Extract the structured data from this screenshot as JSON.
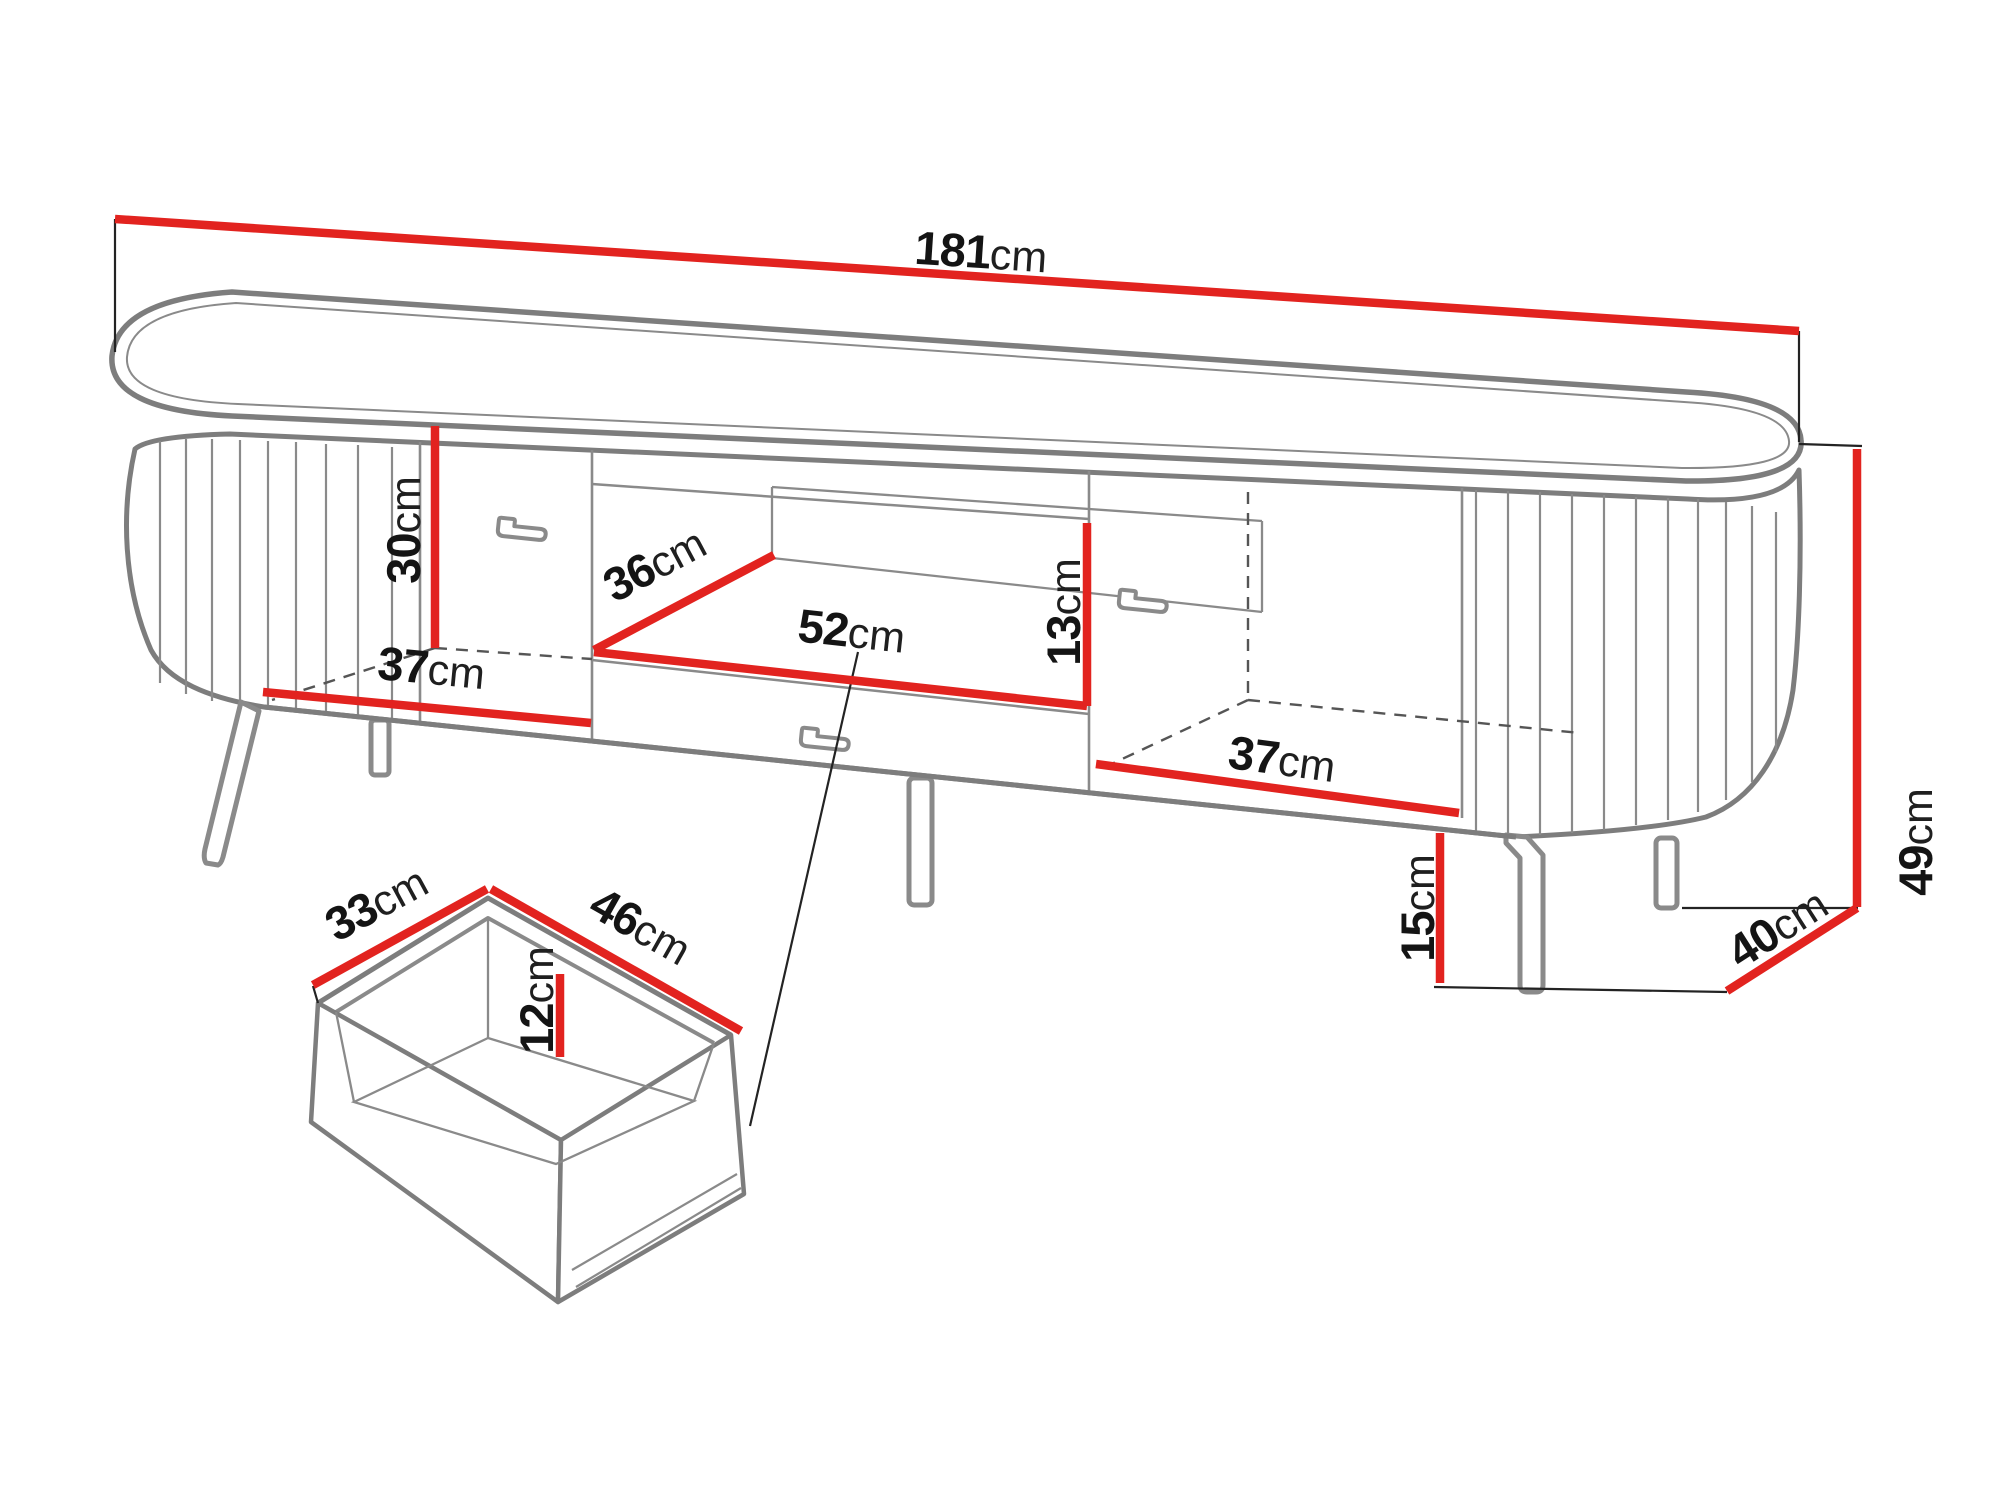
{
  "meta": {
    "title": "TV cabinet dimension diagram",
    "description": "Technical line drawing of an oval fluted TV stand with dimension callouts and a detail view of the inner drawer"
  },
  "colors": {
    "dimension_line": "#e2231f",
    "outline": "#7d7d7d",
    "outline_light": "#8a8a8a",
    "extension_line": "#232323",
    "dashed_line": "#555555",
    "text": "#141414",
    "background": "#ffffff"
  },
  "dims": {
    "total_width": {
      "value": "181",
      "unit": "cm"
    },
    "left_interior_height": {
      "value": "30",
      "unit": "cm"
    },
    "niche_depth": {
      "value": "36",
      "unit": "cm"
    },
    "niche_width": {
      "value": "52",
      "unit": "cm"
    },
    "niche_height": {
      "value": "13",
      "unit": "cm"
    },
    "left_interior_width": {
      "value": "37",
      "unit": "cm"
    },
    "right_interior_width": {
      "value": "37",
      "unit": "cm"
    },
    "total_height": {
      "value": "49",
      "unit": "cm"
    },
    "leg_height": {
      "value": "15",
      "unit": "cm"
    },
    "total_depth": {
      "value": "40",
      "unit": "cm"
    },
    "drawer_inner_depth": {
      "value": "33",
      "unit": "cm"
    },
    "drawer_inner_width": {
      "value": "46",
      "unit": "cm"
    },
    "drawer_inner_height": {
      "value": "12",
      "unit": "cm"
    }
  }
}
